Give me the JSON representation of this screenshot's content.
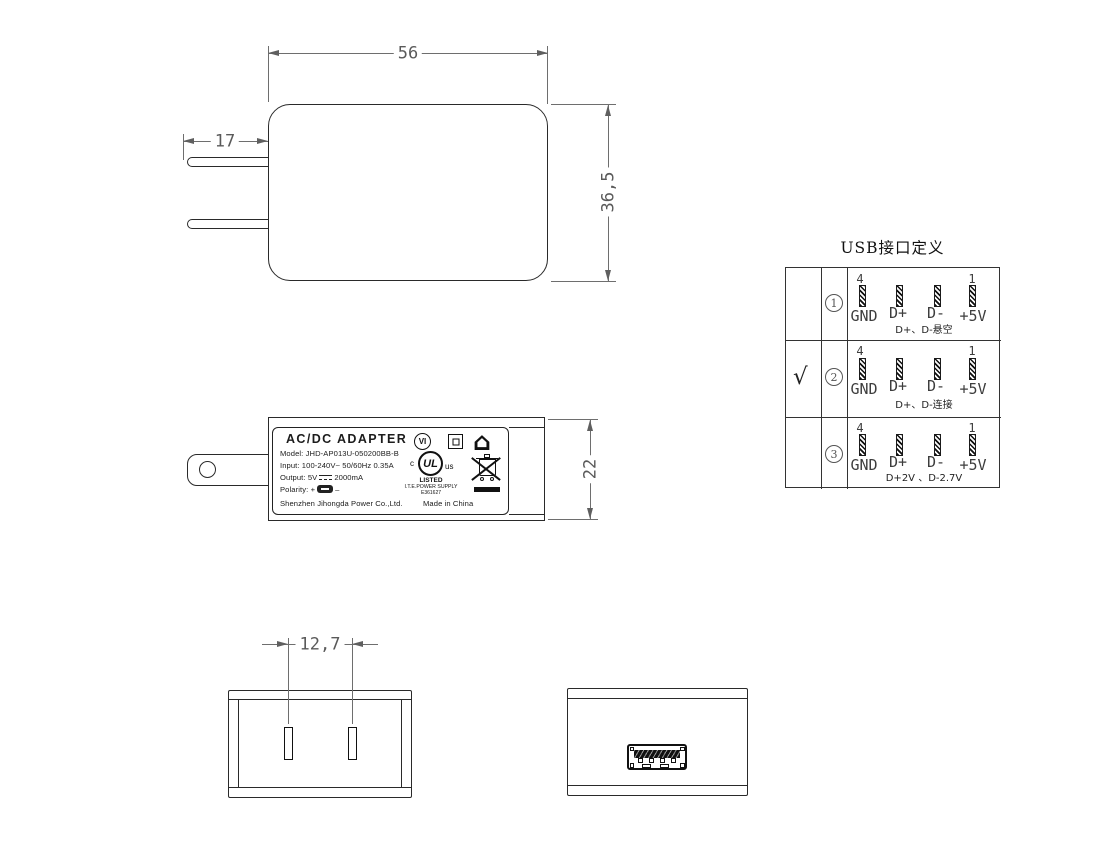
{
  "dimensions": {
    "body_width": "56",
    "prong_length": "17",
    "body_height": "36,5",
    "side_height": "22",
    "prong_spacing": "12,7"
  },
  "label": {
    "title": "AC/DC ADAPTER",
    "model": "Model: JHD-AP013U-050200BB-B",
    "input": "Input: 100-240V~  50/60Hz  0.35A",
    "output_prefix": "Output: 5V",
    "output_value": "2000mA",
    "polarity_prefix": "Polarity:",
    "polarity_plus": "+",
    "polarity_minus": "–",
    "company": "Shenzhen Jihongda Power Co.,Ltd.",
    "origin": "Made in China",
    "marks": {
      "efficiency": "VI",
      "ul_c": "c",
      "ul": "UL",
      "ul_us": "us",
      "ul_listed": "LISTED",
      "ul_type": "I.T.E.POWER SUPPLY",
      "ul_file": "E361627"
    }
  },
  "usb_table": {
    "title": "USB接口定义",
    "pin_top_left": "4",
    "pin_top_right": "1",
    "pin_labels": [
      "GND",
      "D+",
      "D-",
      "+5V"
    ],
    "rows": [
      {
        "num": "1",
        "checked": "",
        "note": "D+、D-悬空"
      },
      {
        "num": "2",
        "checked": "√",
        "note": "D+、D-连接"
      },
      {
        "num": "3",
        "checked": "",
        "note": "D+2V 、D-2.7V"
      }
    ]
  }
}
